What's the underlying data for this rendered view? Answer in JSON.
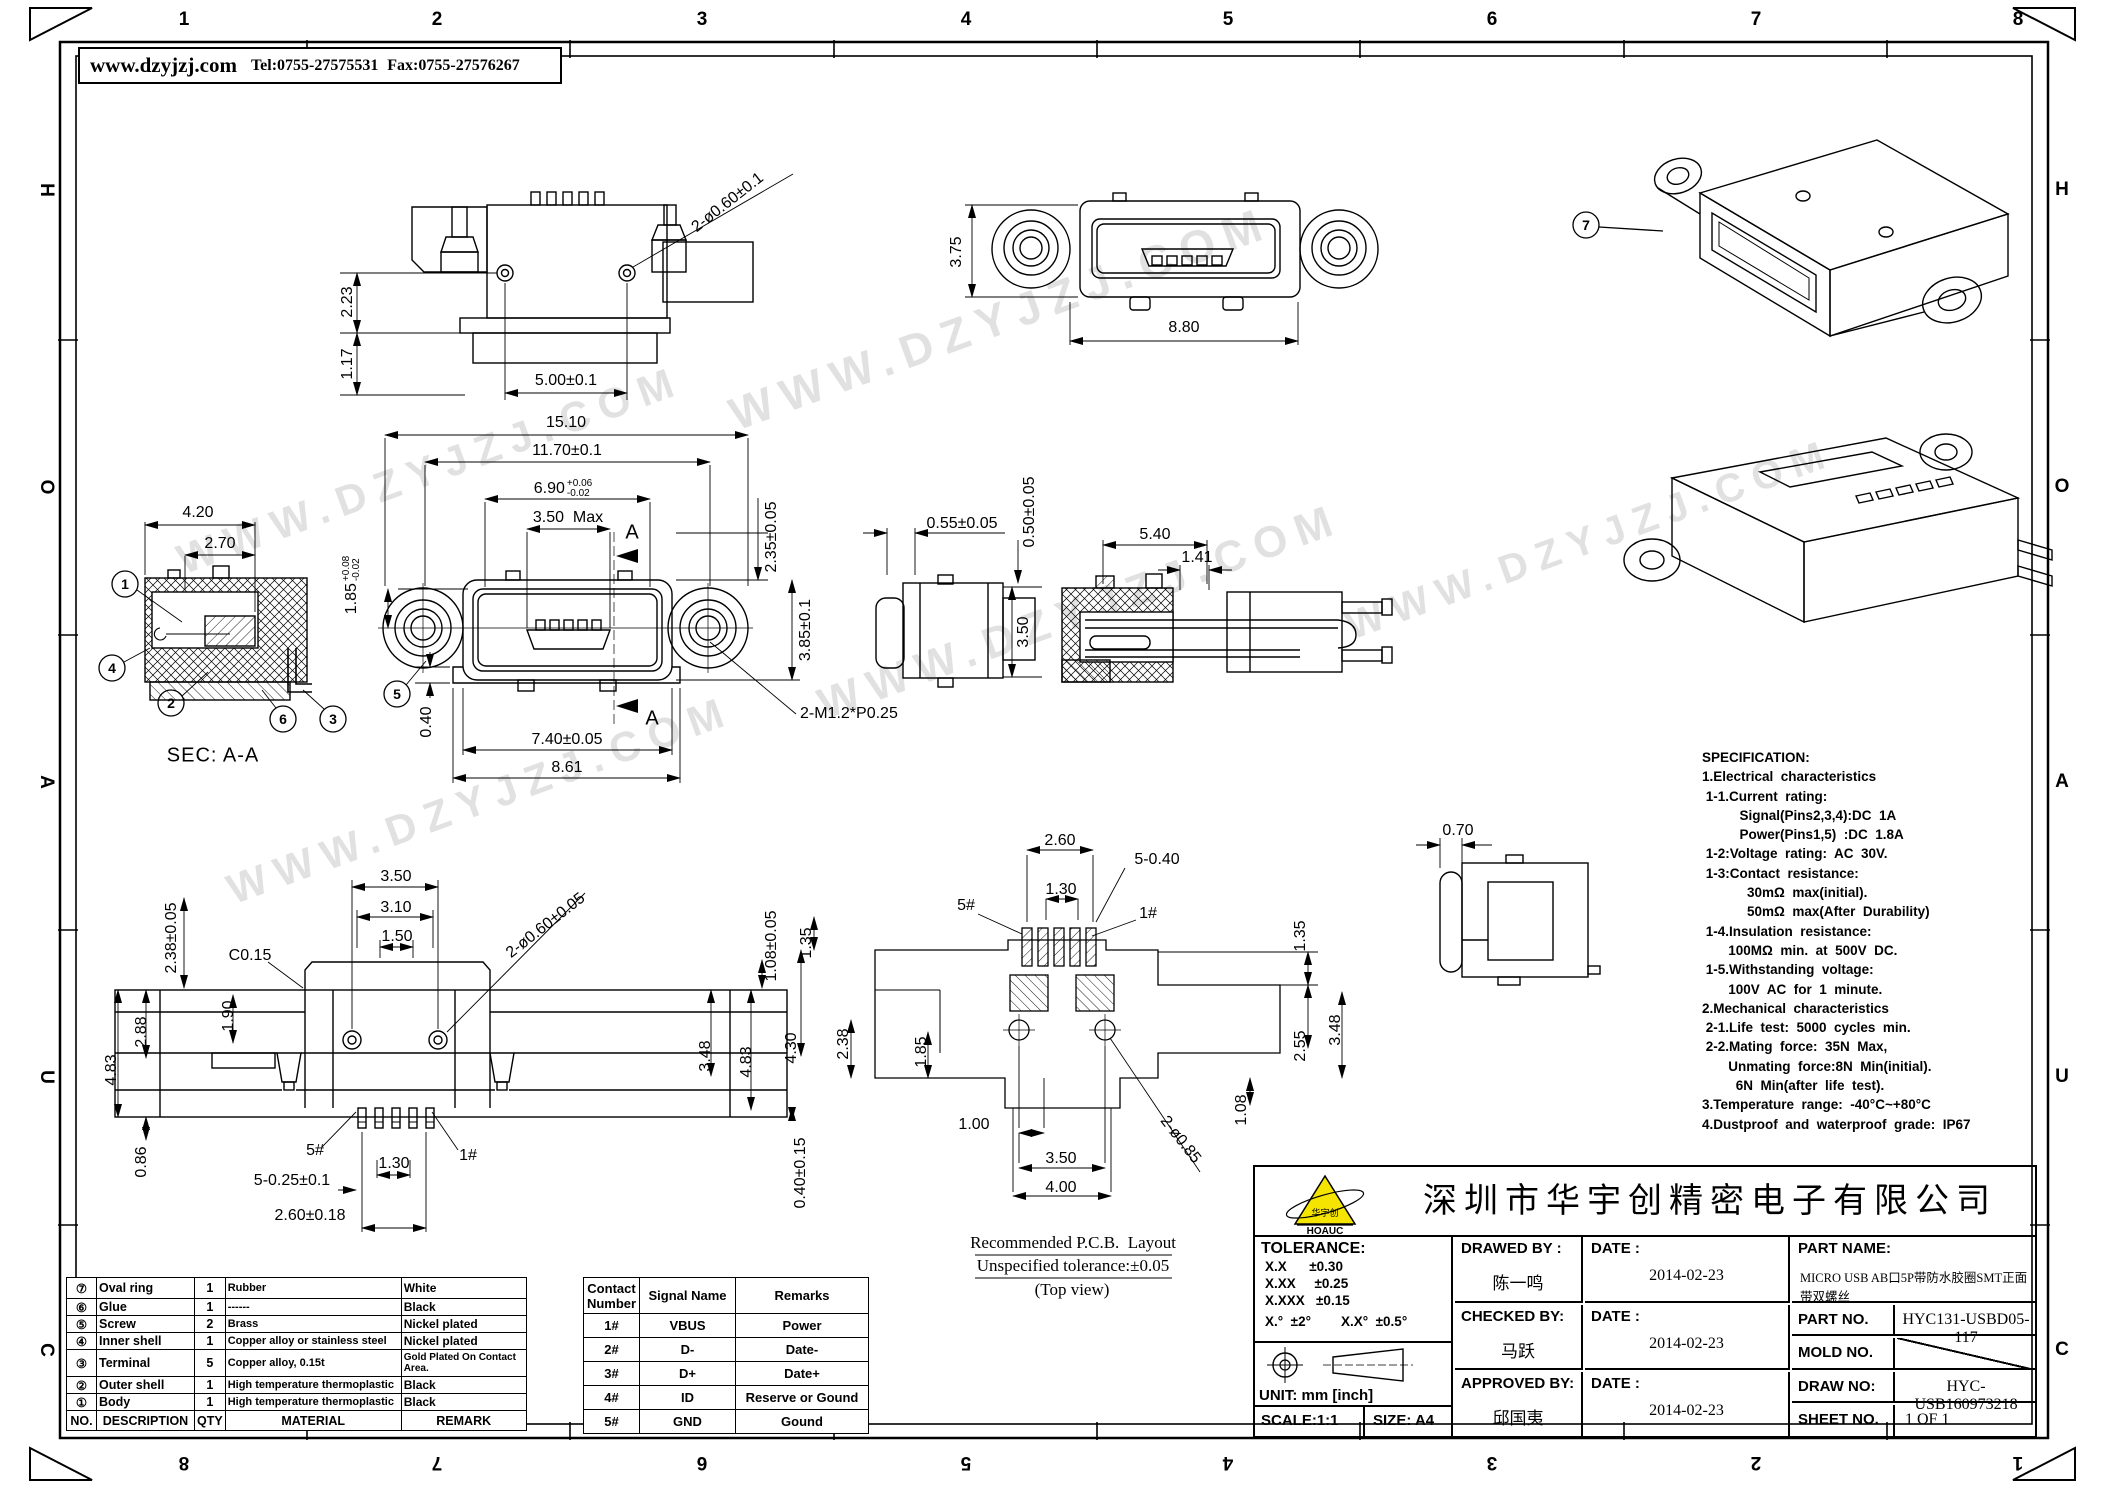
{
  "header": {
    "website": "www.dzyjzj.com",
    "tel": "Tel:0755-27575531",
    "fax": "Fax:0755-27576267"
  },
  "watermark": {
    "text": "WWW.DZYJZJ.COM"
  },
  "border": {
    "top_numbers": [
      "1",
      "2",
      "3",
      "4",
      "5",
      "6",
      "7",
      "8"
    ],
    "bottom_numbers": [
      "8",
      "7",
      "6",
      "5",
      "4",
      "3",
      "2",
      "1"
    ],
    "left_letters": [
      "H",
      "O",
      "A",
      "U",
      "C"
    ],
    "right_letters": [
      "H",
      "O",
      "A",
      "U",
      "C"
    ]
  },
  "callouts": {
    "c1": "1",
    "c2": "2",
    "c3": "3",
    "c4": "4",
    "c5": "5",
    "c6": "6",
    "c7": "7"
  },
  "dims": {
    "tl_hole": "2-ø0.60±0.1",
    "tl_223": "2.23",
    "tl_117": "1.17",
    "tl_500": "5.00±0.1",
    "fv_1510": "15.10",
    "fv_1170": "11.70±0.1",
    "fv_690": "6.90",
    "fv_690_tt": "+0.06",
    "fv_690_tb": "-0.02",
    "fv_350max": "3.50  Max",
    "fv_185": "1.85",
    "fv_185_tt": "+0.08",
    "fv_185_tb": "-0.02",
    "fv_235": "2.35±0.05",
    "fv_385": "3.85±0.1",
    "fv_040": "0.40",
    "fv_740": "7.40±0.05",
    "fv_861": "8.61",
    "fv_m12": "2-M1.2*P0.25",
    "secA_top": "A",
    "secA_bot": "A",
    "sec_420": "4.20",
    "sec_270": "2.70",
    "tm_375": "3.75",
    "tm_880": "8.80",
    "sr_055": "0.55±0.05",
    "sr_050": "0.50±0.05",
    "sr_350": "3.50",
    "cr_540": "5.40",
    "cr_141": "1.41",
    "sv_070": "0.70",
    "bl_350": "3.50",
    "bl_310": "3.10",
    "bl_150": "1.50",
    "bl_c015": "C0.15",
    "bl_hole": "2-ø0.60±0.05",
    "bl_108": "1.08±0.05",
    "bl_238": "2.38±0.05",
    "bl_288": "2.88",
    "bl_483l": "4.83",
    "bl_190": "1.90",
    "bl_086": "0.86",
    "bl_348": "3.48",
    "bl_483r": "4.83",
    "bl_040": "0.40±0.15",
    "bl_5h": "5#",
    "bl_1h": "1#",
    "bl_130": "1.30",
    "bl_5025": "5-0.25±0.1",
    "bl_260": "2.60±0.18",
    "pcb_260": "2.60",
    "pcb_5040": "5-0.40",
    "pcb_130": "1.30",
    "pcb_5h": "5#",
    "pcb_1h": "1#",
    "pcb_135l": "1.35",
    "pcb_430": "4.30",
    "pcb_238": "2.38",
    "pcb_185": "1.85",
    "pcb_135r": "1.35",
    "pcb_255": "2.55",
    "pcb_348": "3.48",
    "pcb_108": "1.08",
    "pcb_100": "1.00",
    "pcb_350": "3.50",
    "pcb_400": "4.00",
    "pcb_hole": "2-ø0.85"
  },
  "captions": {
    "sec": "SEC: A-A",
    "pcb1": "Recommended P.C.B.  Layout",
    "pcb2": "Unspecified tolerance:±0.05",
    "pcb3": "(Top view)"
  },
  "specification": {
    "lines": [
      "SPECIFICATION:",
      "1.Electrical  characteristics",
      " 1-1.Current  rating:",
      "          Signal(Pins2,3,4):DC  1A",
      "          Power(Pins1,5)  :DC  1.8A",
      " 1-2:Voltage  rating:  AC  30V.",
      " 1-3:Contact  resistance:",
      "            30mΩ  max(initial).",
      "            50mΩ  max(After  Durability)",
      " 1-4.Insulation  resistance:",
      "       100MΩ  min.  at  500V  DC.",
      " 1-5.Withstanding  voltage:",
      "       100V  AC  for  1  minute.",
      "2.Mechanical  characteristics",
      " 2-1.Life  test:  5000  cycles  min.",
      " 2-2.Mating  force:  35N  Max,",
      "       Unmating  force:8N  Min(initial).",
      "         6N  Min(after  life  test).",
      "3.Temperature  range:  -40°C~+80°C",
      "4.Dustproof  and  waterproof  grade:  IP67"
    ]
  },
  "materials_table": {
    "rows": [
      [
        "⑦",
        "Oval  ring",
        "1",
        "Rubber",
        "White"
      ],
      [
        "⑥",
        "Glue",
        "1",
        "------",
        "Black"
      ],
      [
        "⑤",
        "Screw",
        "2",
        "Brass",
        "Nickel  plated"
      ],
      [
        "④",
        "Inner  shell",
        "1",
        "Copper alloy or stainless steel",
        "Nickel  plated"
      ],
      [
        "③",
        "Terminal",
        "5",
        "Copper alloy, 0.15t",
        "Gold Plated On Contact Area."
      ],
      [
        "②",
        "Outer  shell",
        "1",
        "High temperature thermoplastic",
        "Black"
      ],
      [
        "①",
        "Body",
        "1",
        "High temperature thermoplastic",
        "Black"
      ]
    ],
    "footer": [
      "NO.",
      "DESCRIPTION",
      "QTY",
      "MATERIAL",
      "REMARK"
    ]
  },
  "contact_table": {
    "headers": [
      "Contact Number",
      "Signal  Name",
      "Remarks"
    ],
    "rows": [
      [
        "1#",
        "VBUS",
        "Power"
      ],
      [
        "2#",
        "D-",
        "Date-"
      ],
      [
        "3#",
        "D+",
        "Date+"
      ],
      [
        "4#",
        "ID",
        "Reserve  or  Gound"
      ],
      [
        "5#",
        "GND",
        "Gound"
      ]
    ]
  },
  "title_block": {
    "company": "深圳市华宇创精密电子有限公司",
    "logo_text": "HOAUC",
    "logo_mark": "华宇创",
    "tolerance_title": "TOLERANCE:",
    "tolerance_lines": [
      "X.X      ±0.30",
      "X.XX     ±0.25",
      "X.XXX   ±0.15"
    ],
    "tolerance_angle": "X.°  ±2°        X.X°  ±0.5°",
    "unit": "UNIT:  mm  [inch]",
    "scale": "SCALE:1:1",
    "size": "SIZE:  A4",
    "rows": [
      {
        "role": "DRAWED  BY :",
        "name": "陈一鸣",
        "date_label": "DATE :",
        "date": "2014-02-23"
      },
      {
        "role": "CHECKED  BY:",
        "name": "马跃",
        "date_label": "DATE :",
        "date": "2014-02-23"
      },
      {
        "role": "APPROVED  BY:",
        "name": "邱国夷",
        "date_label": "DATE :",
        "date": "2014-02-23"
      }
    ],
    "part_name_label": "PART  NAME:",
    "part_name": "MICRO USB AB口5P带防水胶圈SMT正面带双螺丝",
    "part_no_label": "PART  NO.",
    "part_no": "HYC131-USBD05-117",
    "mold_no_label": "MOLD  NO.",
    "mold_no": "",
    "draw_no_label": "DRAW  NO:",
    "draw_no": "HYC-USB160973218",
    "sheet_no_label": "SHEET  NO.",
    "sheet_no": "1  OF  1"
  }
}
